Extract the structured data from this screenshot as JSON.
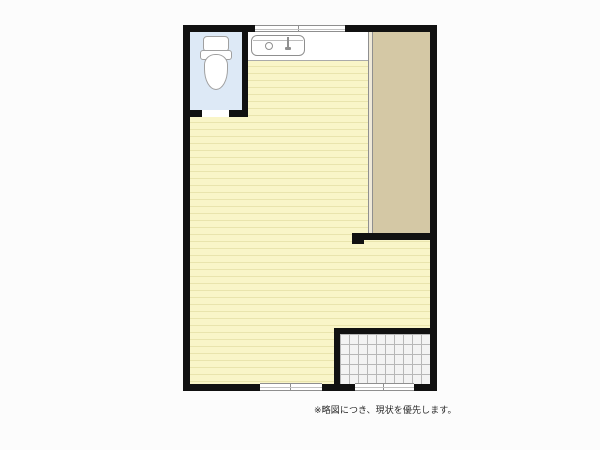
{
  "floorplan": {
    "note": "※略図につき、現状を優先します。",
    "icons": {
      "toilet": "toilet-icon",
      "kitchen_sink": "sink-icon"
    },
    "colors": {
      "wall": "#111111",
      "bg": "#fcfcfc",
      "wood": "#f9f5c8",
      "wood-line": "#e9e4ad",
      "toilet": "#dde9f6",
      "closet": "#d4c8a5",
      "closet-track": "#efe9d8",
      "tile": "#f3f3f3",
      "tile-line": "#b7b7b7",
      "outline": "#8f8f8f",
      "counter": "#ffffff",
      "text": "#2a2a2a"
    }
  }
}
